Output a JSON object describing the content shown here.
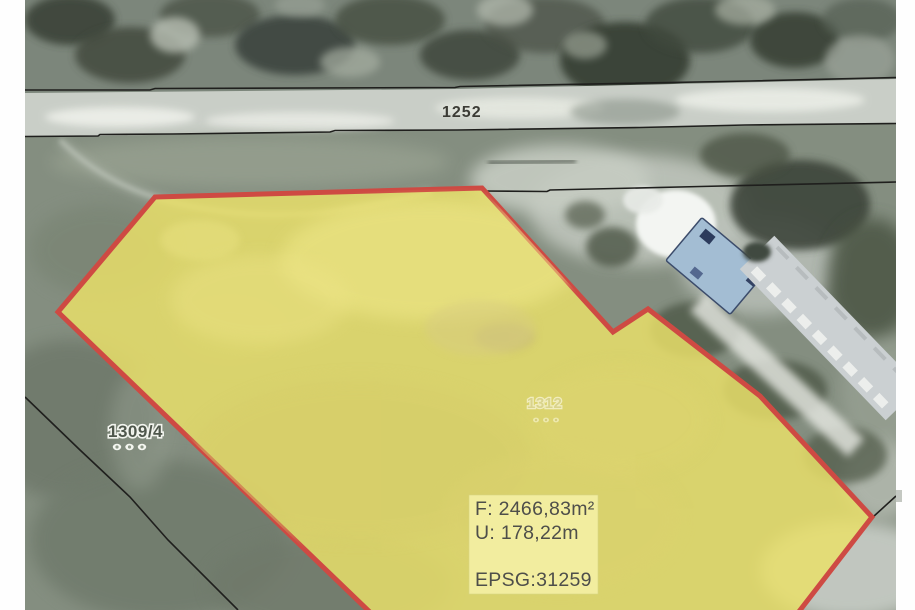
{
  "map": {
    "type": "cadastral-orthophoto-extract",
    "road_parcel": {
      "label": "1252"
    },
    "neighbor_parcel": {
      "label": "1309/4"
    },
    "highlighted_parcel": {
      "label": "1312"
    },
    "info_box": {
      "area": "F: 2466,83m²",
      "perimeter": "U: 178,22m",
      "epsg": "EPSG:31259"
    },
    "colors": {
      "parcel_fill": "#e9e069",
      "parcel_border": "#ce4a43",
      "info_box_bg": "#f3eea1",
      "boundary_line": "#1f1f1d",
      "road": "#c9cec7",
      "field": "#848e80",
      "canopy": "#7c867b",
      "label_dark": "#3b3b35",
      "label_halo": "#f2f4ee"
    }
  }
}
